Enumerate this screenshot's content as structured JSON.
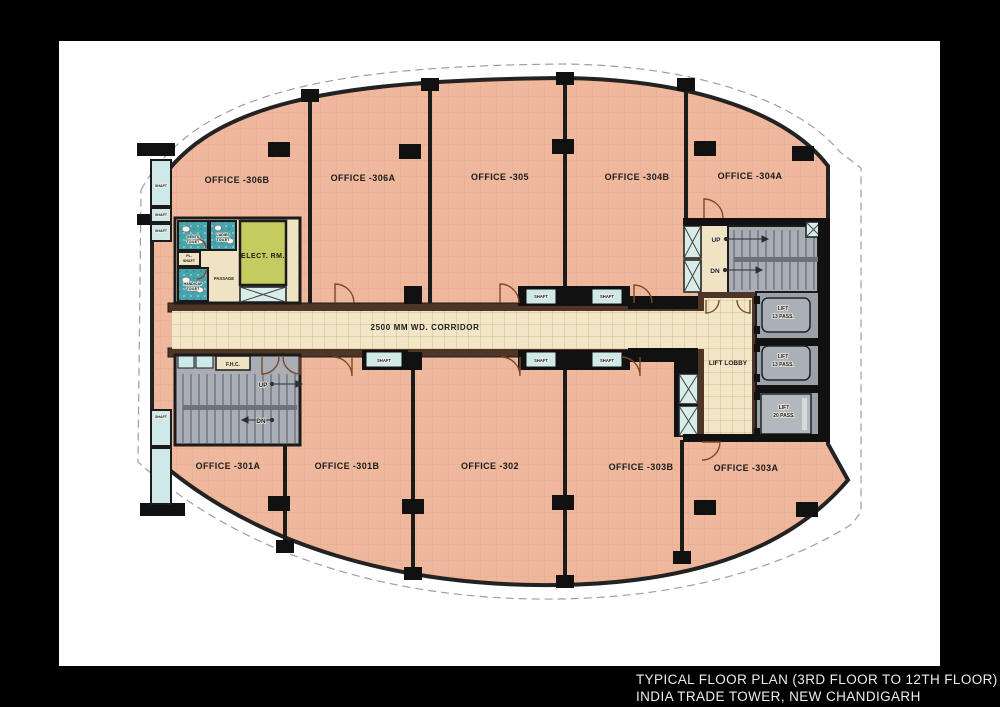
{
  "title": {
    "line1": "TYPICAL FLOOR PLAN (3RD FLOOR TO 12TH FLOOR)",
    "line2": "INDIA TRADE TOWER, NEW CHANDIGARH"
  },
  "plan": {
    "corridor_label": "2500 MM WD. CORRIDOR",
    "offices": {
      "o306b": "OFFICE -306B",
      "o306a": "OFFICE -306A",
      "o305": "OFFICE -305",
      "o304b": "OFFICE -304B",
      "o304a": "OFFICE -304A",
      "o301a": "OFFICE -301A",
      "o301b": "OFFICE -301B",
      "o302": "OFFICE -302",
      "o303b": "OFFICE -303B",
      "o303a": "OFFICE -303A"
    },
    "labels": {
      "shaft": "SHAFT",
      "lift_lobby": "LIFT LOBBY",
      "lift": "LIFT",
      "pass13": "13 PASS.",
      "pass20": "20 PASS.",
      "up": "UP",
      "dn": "DN",
      "fhc": "F.H.C.",
      "elect": "ELECT. RM.",
      "passage": "PASSAGE",
      "gents_l1": "GENTS",
      "gents_l2": "TOILET",
      "ladies_l1": "LADIES",
      "ladies_l2": "TOILET",
      "handicap_l1": "HANDICAP",
      "handicap_l2": "TOILET",
      "pl_l1": "PL.",
      "pl_l2": "SHAFT"
    }
  },
  "colors": {
    "frame": "#000000",
    "paper": "#ffffff",
    "office_fill": "#efb79c",
    "corridor_fill": "#f2e6c7",
    "wall_brown": "#4f3526",
    "toilet_fill": "#47a3ac",
    "elect_fill": "#c6cb5f",
    "stair_fill": "#a9aeb6",
    "shaft_fill": "#cfe9e9",
    "lift_fill": "#9ba1a9",
    "title_text": "#ececec"
  }
}
